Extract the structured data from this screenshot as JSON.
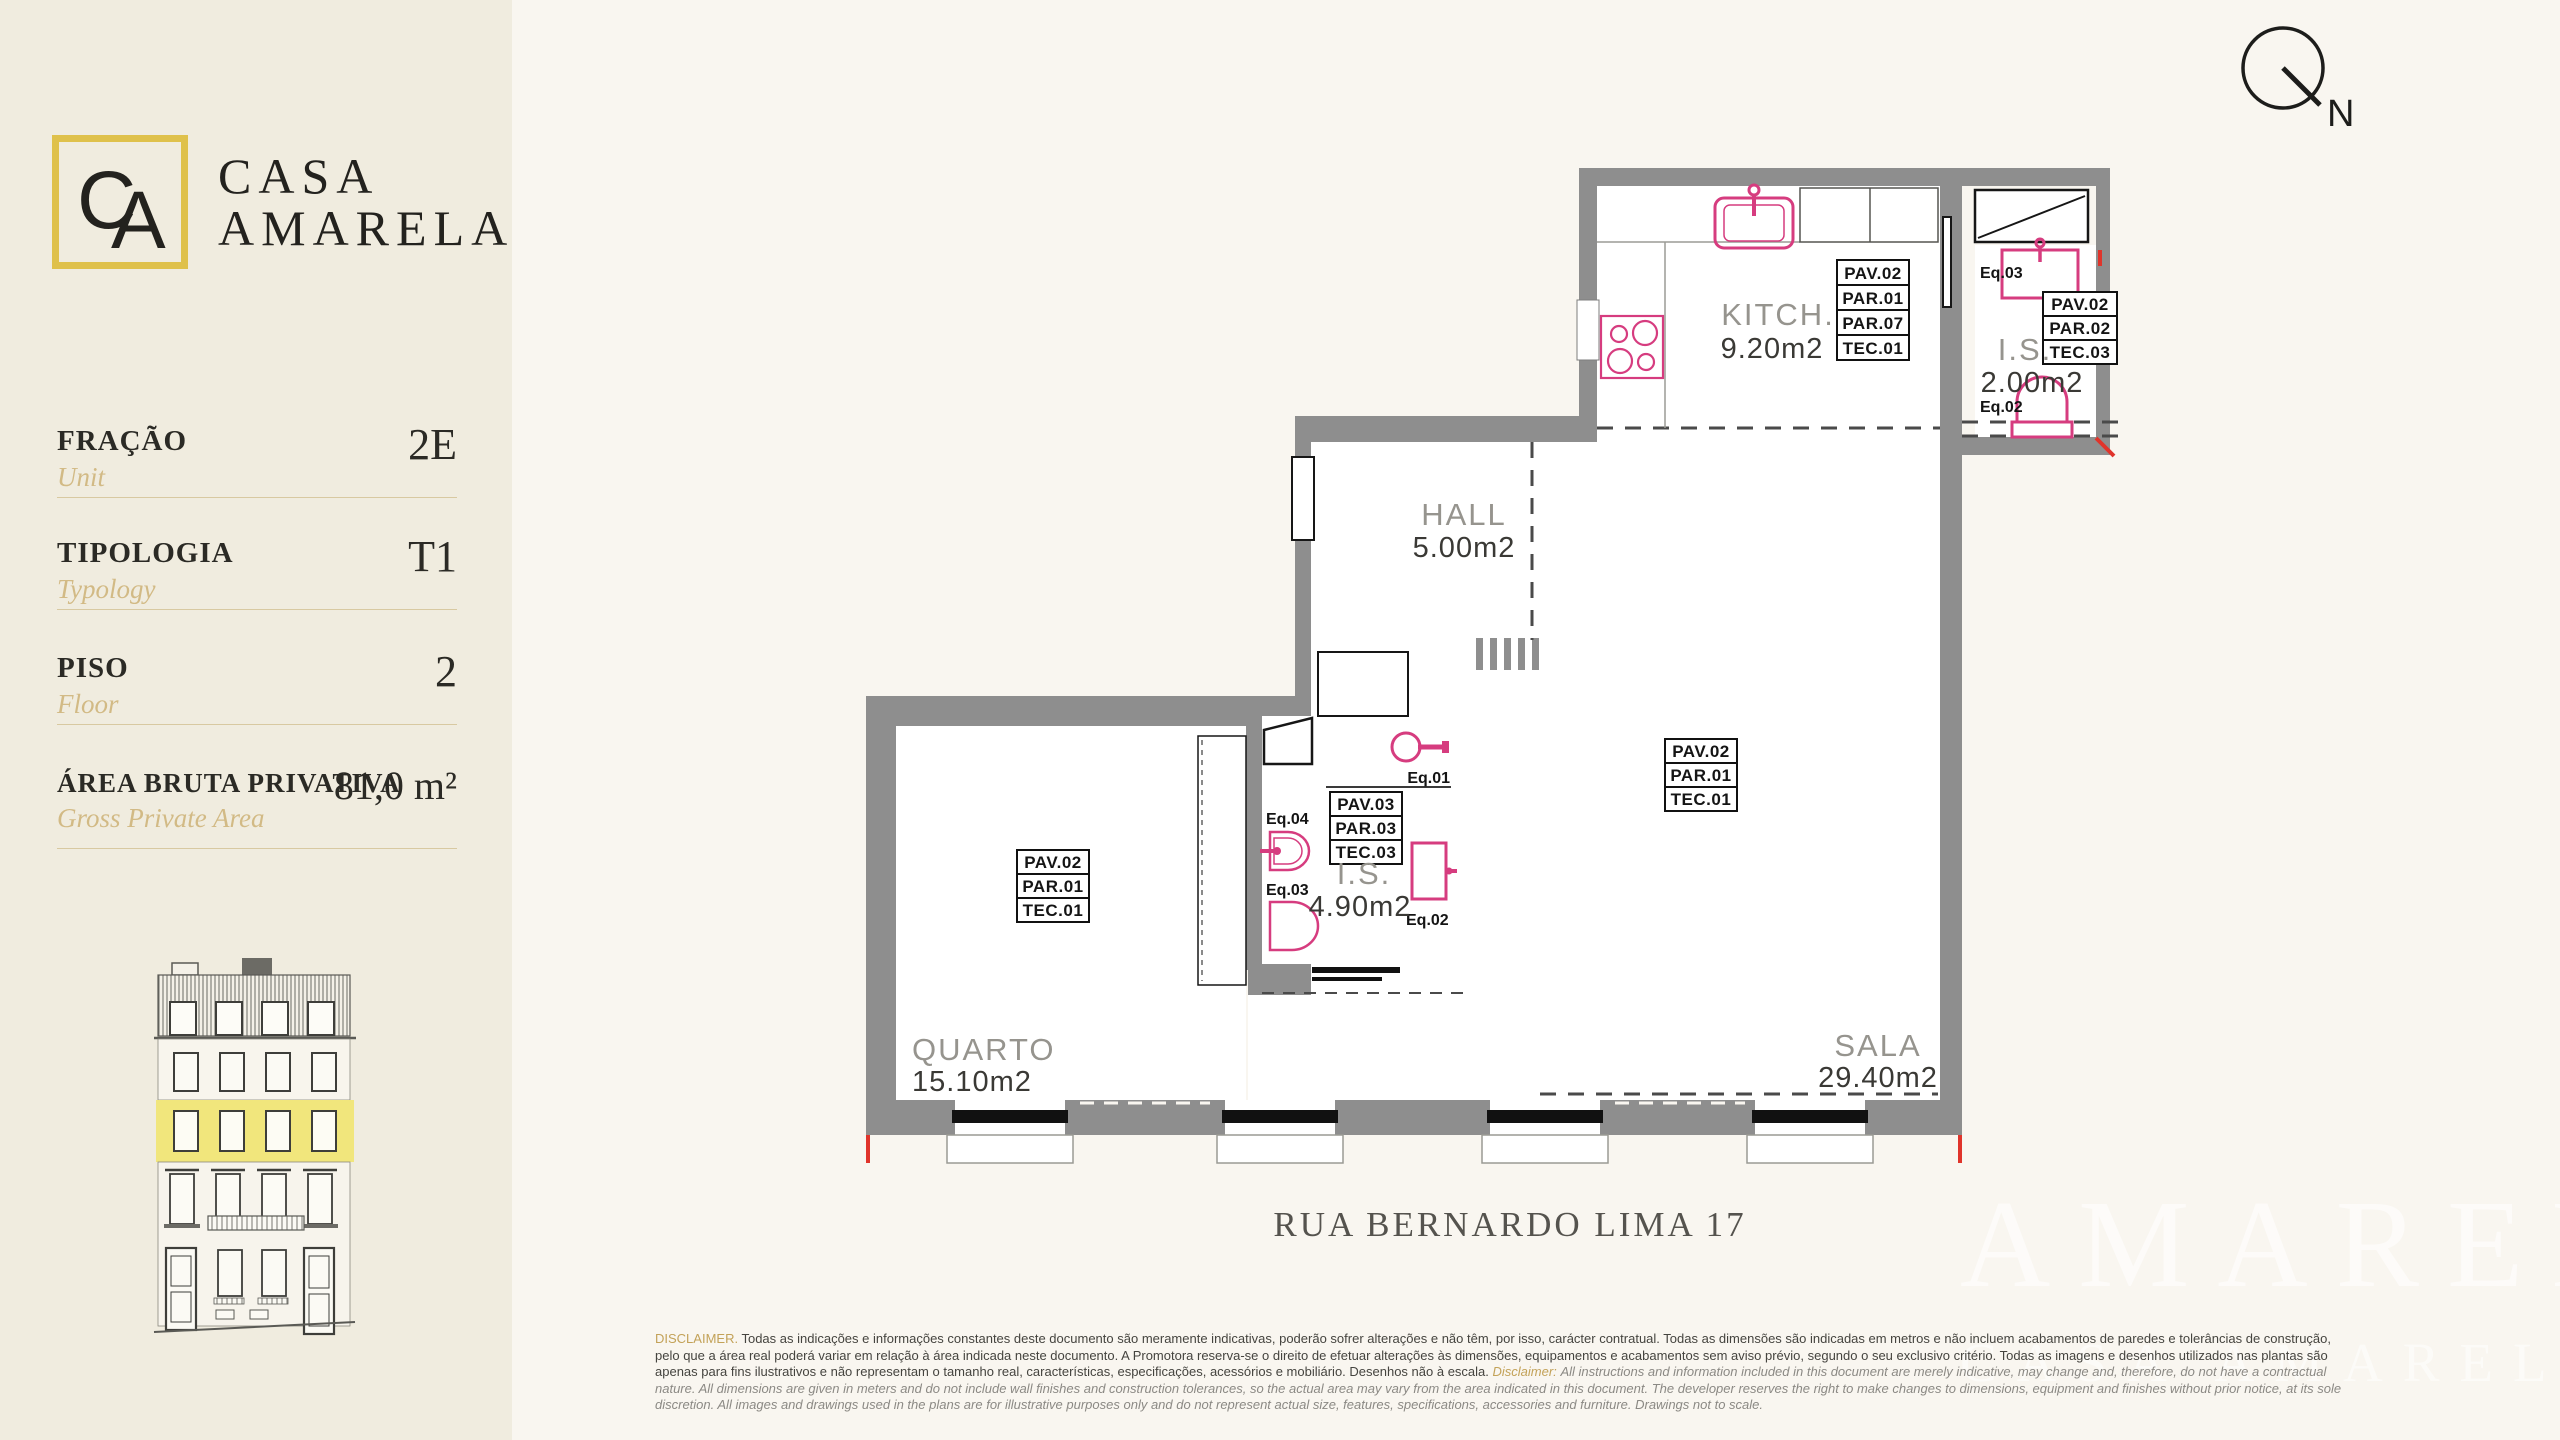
{
  "brand": {
    "monogram_c": "C",
    "monogram_a": "A",
    "name_line1": "CASA",
    "name_line2": "AMARELA"
  },
  "sidebar": {
    "rows": [
      {
        "label": "FRAÇÃO",
        "sublabel": "Unit",
        "value": "2E"
      },
      {
        "label": "TIPOLOGIA",
        "sublabel": "Typology",
        "value": "T1"
      },
      {
        "label": "PISO",
        "sublabel": "Floor",
        "value": "2"
      },
      {
        "label": "ÁREA BRUTA PRIVATIVA",
        "sublabel": "Gross Private Area",
        "value": "81,0 m²"
      }
    ]
  },
  "plan": {
    "north": "N",
    "rooms": {
      "kitchen": {
        "name": "KITCH.",
        "area": "9.20m2"
      },
      "hall": {
        "name": "HALL",
        "area": "5.00m2"
      },
      "wc_small": {
        "name": "I.S.",
        "area": "2.00m2"
      },
      "wc_main": {
        "name": "I.S.",
        "area": "4.90m2"
      },
      "bedroom": {
        "name": "QUARTO",
        "area": "15.10m2"
      },
      "living": {
        "name": "SALA",
        "area": "29.40m2"
      }
    },
    "tags": {
      "kitchen": [
        "PAV.02",
        "PAR.01",
        "PAR.07",
        "TEC.01"
      ],
      "wc_small": [
        "PAV.02",
        "PAR.02",
        "TEC.03"
      ],
      "wc_main": [
        "PAV.03",
        "PAR.03",
        "TEC.03"
      ],
      "bedroom": [
        "PAV.02",
        "PAR.01",
        "TEC.01"
      ],
      "living": [
        "PAV.02",
        "PAR.01",
        "TEC.01"
      ]
    },
    "eq": {
      "e1": "Eq.01",
      "e2": "Eq.02",
      "e3": "Eq.03",
      "e4": "Eq.04"
    }
  },
  "address": "RUA BERNARDO LIMA 17",
  "disclaimer": {
    "label_pt": "DISCLAIMER.",
    "text_pt": "Todas as indicações e informações constantes deste documento são meramente indicativas, poderão sofrer alterações e não têm, por isso, carácter contratual. Todas as dimensões são indicadas em metros e não incluem acabamentos de paredes e tolerâncias de construção, pelo que a área real poderá variar em relação à área indicada neste documento. A Promotora reserva-se o direito de efetuar alterações às dimensões, equipamentos e acabamentos sem aviso prévio, segundo o seu exclusivo critério. Todas as imagens e desenhos utilizados nas plantas são apenas para fins ilustrativos e não representam o tamanho real, características, especificações, acessórios e mobiliário. Desenhos não à escala.",
    "label_en": "Disclaimer:",
    "text_en": "All instructions and information included in this document are merely indicative, may change and, therefore, do not have a contractual nature. All dimensions are given in meters and do not include wall finishes and construction tolerances, so the actual area may vary from the area indicated in this document. The developer reserves the right to make changes to dimensions, equipment and finishes without prior notice, at its sole discretion. All images and drawings used in the plans are for illustrative purposes only and do not represent actual size, features, specifications, accessories and furniture. Drawings not to scale."
  },
  "watermark": {
    "line1": "AMARELA",
    "line2": "CASA AMARELA"
  },
  "colors": {
    "sidebar_bg": "#f0ecdf",
    "main_bg": "#f9f6f0",
    "accent_gold": "#dfc14b",
    "highlight_yellow": "#f1e67c",
    "wall_gray": "#8e8e8e",
    "fixture_pink": "#d63c7f",
    "marker_red": "#e0342b"
  }
}
